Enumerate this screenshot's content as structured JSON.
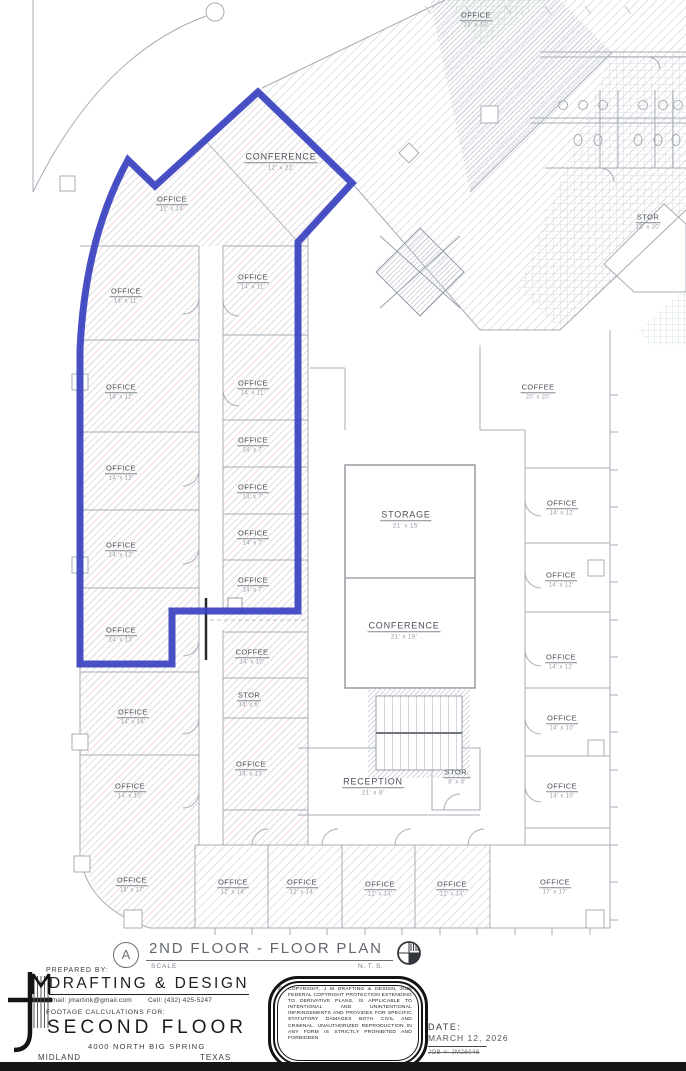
{
  "plan": {
    "detail_letter": "A",
    "title": "2ND FLOOR - FLOOR PLAN",
    "scale_label": "SCALE",
    "scale_value": "N. T. S.",
    "highlight_color": "#3a41c1",
    "rooms": [
      {
        "name": "OFFICE",
        "dims": "12' x 10'"
      },
      {
        "name": "CONFERENCE",
        "dims": "12' x 22'"
      },
      {
        "name": "OFFICE",
        "dims": "12' x 14'"
      },
      {
        "name": "STOR",
        "dims": "18' x 20'"
      },
      {
        "name": "OFFICE",
        "dims": "14' x 11'"
      },
      {
        "name": "OFFICE",
        "dims": "14' x 11'"
      },
      {
        "name": "OFFICE",
        "dims": "14' x 11'"
      },
      {
        "name": "OFFICE",
        "dims": "14' x 12'"
      },
      {
        "name": "OFFICE",
        "dims": "14' x 7'"
      },
      {
        "name": "OFFICE",
        "dims": "14' x 12'"
      },
      {
        "name": "OFFICE",
        "dims": "14' x 7'"
      },
      {
        "name": "OFFICE",
        "dims": "14' x 7'"
      },
      {
        "name": "OFFICE",
        "dims": "14' x 12'"
      },
      {
        "name": "OFFICE",
        "dims": "14' x 7'"
      },
      {
        "name": "OFFICE",
        "dims": "14' x 13'"
      },
      {
        "name": "COFFEE",
        "dims": "14' x 10'"
      },
      {
        "name": "STOR",
        "dims": "14' x 6'"
      },
      {
        "name": "OFFICE",
        "dims": "14' x 14'"
      },
      {
        "name": "OFFICE",
        "dims": "14' x 13'"
      },
      {
        "name": "OFFICE",
        "dims": "14' x 10'"
      },
      {
        "name": "COFFEE",
        "dims": "20' x 20'"
      },
      {
        "name": "STORAGE",
        "dims": "21' x 15'"
      },
      {
        "name": "OFFICE",
        "dims": "14' x 12'"
      },
      {
        "name": "OFFICE",
        "dims": "14' x 12'"
      },
      {
        "name": "CONFERENCE",
        "dims": "21' x 18'"
      },
      {
        "name": "OFFICE",
        "dims": "14' x 12'"
      },
      {
        "name": "OFFICE",
        "dims": "14' x 10'"
      },
      {
        "name": "RECEPTION",
        "dims": "21' x 8'"
      },
      {
        "name": "STOR.",
        "dims": "8' x 8'"
      },
      {
        "name": "OFFICE",
        "dims": "14' x 10'"
      },
      {
        "name": "OFFICE",
        "dims": "18' x 17'"
      },
      {
        "name": "OFFICE",
        "dims": "12' x 14'"
      },
      {
        "name": "OFFICE",
        "dims": "12' x 14'"
      },
      {
        "name": "OFFICE",
        "dims": "12' x 14'"
      },
      {
        "name": "OFFICE",
        "dims": "12' x 14'"
      },
      {
        "name": "OFFICE",
        "dims": "17' x 17'"
      }
    ]
  },
  "title_block": {
    "prepared_by": "PREPARED BY:",
    "company": "DRAFTING & DESIGN",
    "email": "Email:  jmartink@gmail.com",
    "cell": "Cell:  (432) 425-5247",
    "footage_line": "FOOTAGE CALCULATIONS FOR:",
    "project": "SECOND FLOOR",
    "address": "4000 NORTH BIG SPRING",
    "city": "MIDLAND",
    "state": "TEXAS"
  },
  "stamp": {
    "symbol": "©",
    "text": "COPYRIGHT, J M DRAFTING & DESIGN, 2026 FEDERAL COPYRIGHT PROTECTION EXTENDING TO DERIVATIVE PLANS, IS APPLICABLE TO INTENTIONAL AND UNINTENTIONAL INFRINGEMENTS AND PROVIDES FOR SPECIFIC STATUTORY DAMAGES BOTH CIVIL AND CRIMINAL. UNAUTHORIZED REPRODUCTION IN ANY FORM IS STRICTLY PROHIBITED AND FORBIDDEN"
  },
  "date_block": {
    "label": "DATE:",
    "date": "MARCH 12, 2026",
    "struck_note": "—————————————",
    "job": "JOB #: JM26046"
  }
}
